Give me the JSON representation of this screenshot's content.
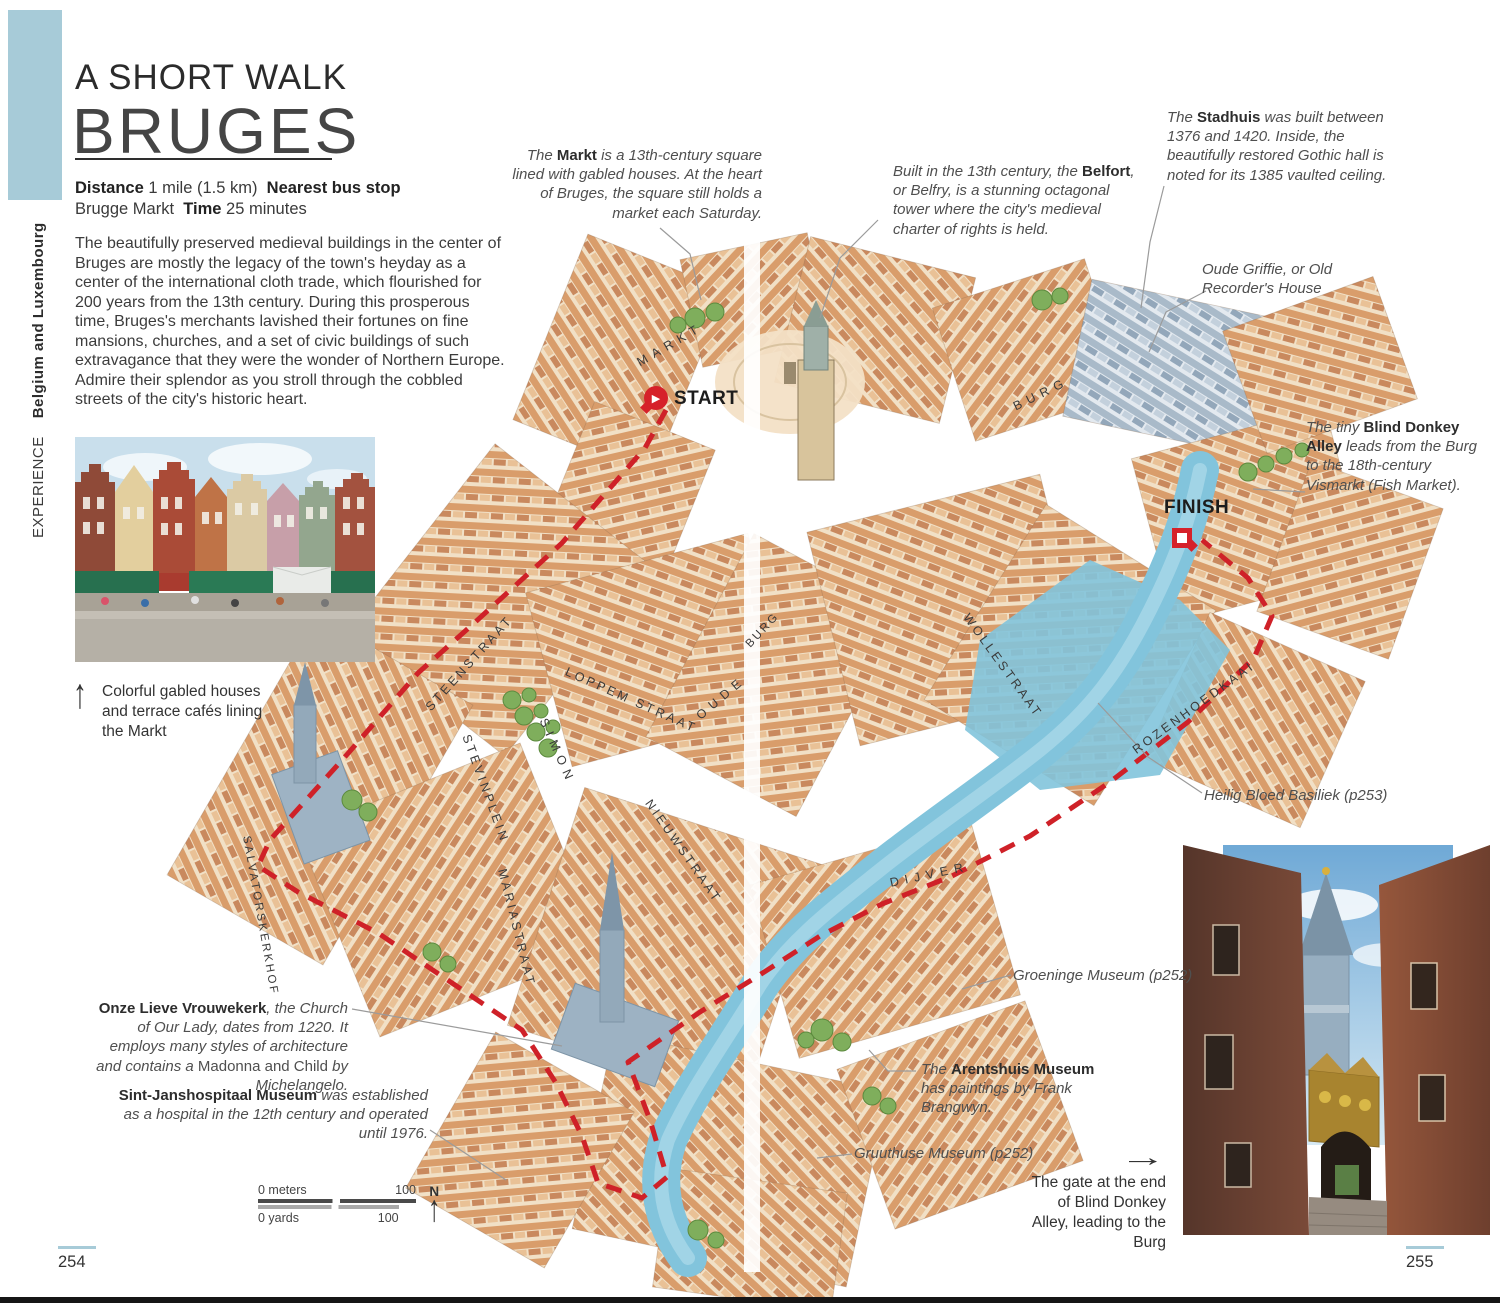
{
  "accent": {
    "blue": "#a7cbd8",
    "route_red": "#cf2128"
  },
  "sidebar": {
    "experience": "EXPERIENCE",
    "region": "Belgium and Luxembourg"
  },
  "header": {
    "kicker": "A SHORT WALK",
    "title": "BRUGES"
  },
  "info": {
    "distance_label": "Distance",
    "distance_value": "1 mile (1.5 km)",
    "bus_label": "Nearest bus stop",
    "bus_value": "Brugge Markt",
    "time_label": "Time",
    "time_value": "25 minutes"
  },
  "intro": {
    "text": "The beautifully preserved medieval buildings in the center of Bruges are mostly the legacy of the town's heyday as a center of the international cloth trade, which flourished for 200 years from the 13th century. During this prosperous time, Bruges's merchants lavished their fortunes on fine mansions, churches, and a set of civic buildings of such extravagance that they were the wonder of Northern Europe. Admire their splendor as you stroll through the cobbled streets of the city's historic heart."
  },
  "captions": {
    "markt_photo": "Colorful gabled houses and terrace cafés lining the Markt",
    "gate_photo": "The gate at the end of Blind Donkey Alley, leading to the Burg"
  },
  "annotations": {
    "markt": [
      {
        "t": "The ",
        "c": "i"
      },
      {
        "t": "Markt",
        "c": "b"
      },
      {
        "t": " is a 13th-century square lined with gabled houses. At the heart of Bruges, the square still holds a market each Saturday.",
        "c": "i"
      }
    ],
    "belfort": [
      {
        "t": "Built in the 13th century, the ",
        "c": "i"
      },
      {
        "t": "Belfort",
        "c": "b"
      },
      {
        "t": ", or Belfry, is a stunning octagonal tower where the city's medieval charter of rights is held.",
        "c": "i"
      }
    ],
    "stadhuis": [
      {
        "t": "The ",
        "c": "i"
      },
      {
        "t": "Stadhuis",
        "c": "b"
      },
      {
        "t": " was built between 1376 and 1420. Inside, the beautifully restored Gothic hall is noted for its 1385 vaulted ceiling.",
        "c": "i"
      }
    ],
    "oude_griffie": [
      {
        "t": "Oude Griffie, or Old Recorder's House",
        "c": "i"
      }
    ],
    "blind_donkey": [
      {
        "t": "The tiny ",
        "c": "i"
      },
      {
        "t": "Blind Donkey Alley",
        "c": "b"
      },
      {
        "t": " leads from the Burg to the 18th-century Vismarkt (Fish Market).",
        "c": "i"
      }
    ],
    "heilig_bloed": [
      {
        "t": "Heilig Bloed Basiliek (p253)",
        "c": "i"
      }
    ],
    "groeninge": [
      {
        "t": "Groeninge Museum (p252)",
        "c": "i"
      }
    ],
    "arentshuis": [
      {
        "t": "The ",
        "c": "i"
      },
      {
        "t": "Arentshuis Museum",
        "c": "b"
      },
      {
        "t": " has paintings by Frank Brangwyn.",
        "c": "i"
      }
    ],
    "gruuthuse": [
      {
        "t": "Gruuthuse Museum (p252)",
        "c": "i"
      }
    ],
    "onze_lieve": [
      {
        "t": "Onze Lieve Vrouwekerk",
        "c": "b"
      },
      {
        "t": ", the Church of Our Lady, dates from 1220. It employs many styles of architecture and contains a ",
        "c": "i"
      },
      {
        "t": "Madonna and Child",
        "c": "r"
      },
      {
        "t": " by Michelangelo.",
        "c": "i"
      }
    ],
    "sint_jans": [
      {
        "t": "Sint-Janshospitaal Museum",
        "c": "b"
      },
      {
        "t": " was established as a hospital in the 12th century and operated until 1976.",
        "c": "i"
      }
    ]
  },
  "map": {
    "start": "START",
    "finish": "FINISH",
    "streets": [
      {
        "label": "MARKT"
      },
      {
        "label": "BURG"
      },
      {
        "label": "BURG"
      },
      {
        "label": "STEENSTRAAT"
      },
      {
        "label": "LOPPEM STRAAT"
      },
      {
        "label": "SIMON"
      },
      {
        "label": "STEVINPLEIN"
      },
      {
        "label": "OUDE"
      },
      {
        "label": "NIEUWSTRAAT"
      },
      {
        "label": "MARIASTRAAT"
      },
      {
        "label": "SALVATORSKERKHOF"
      },
      {
        "label": "WOLLESTRAAT"
      },
      {
        "label": "ROZENHOEDKAAI"
      },
      {
        "label": "DIJVER"
      }
    ],
    "scale": {
      "meters_label": "0 meters",
      "meters_max": "100",
      "yards_label": "0 yards",
      "yards_max": "100",
      "north": "N"
    }
  },
  "page_numbers": {
    "left": "254",
    "right": "255"
  }
}
